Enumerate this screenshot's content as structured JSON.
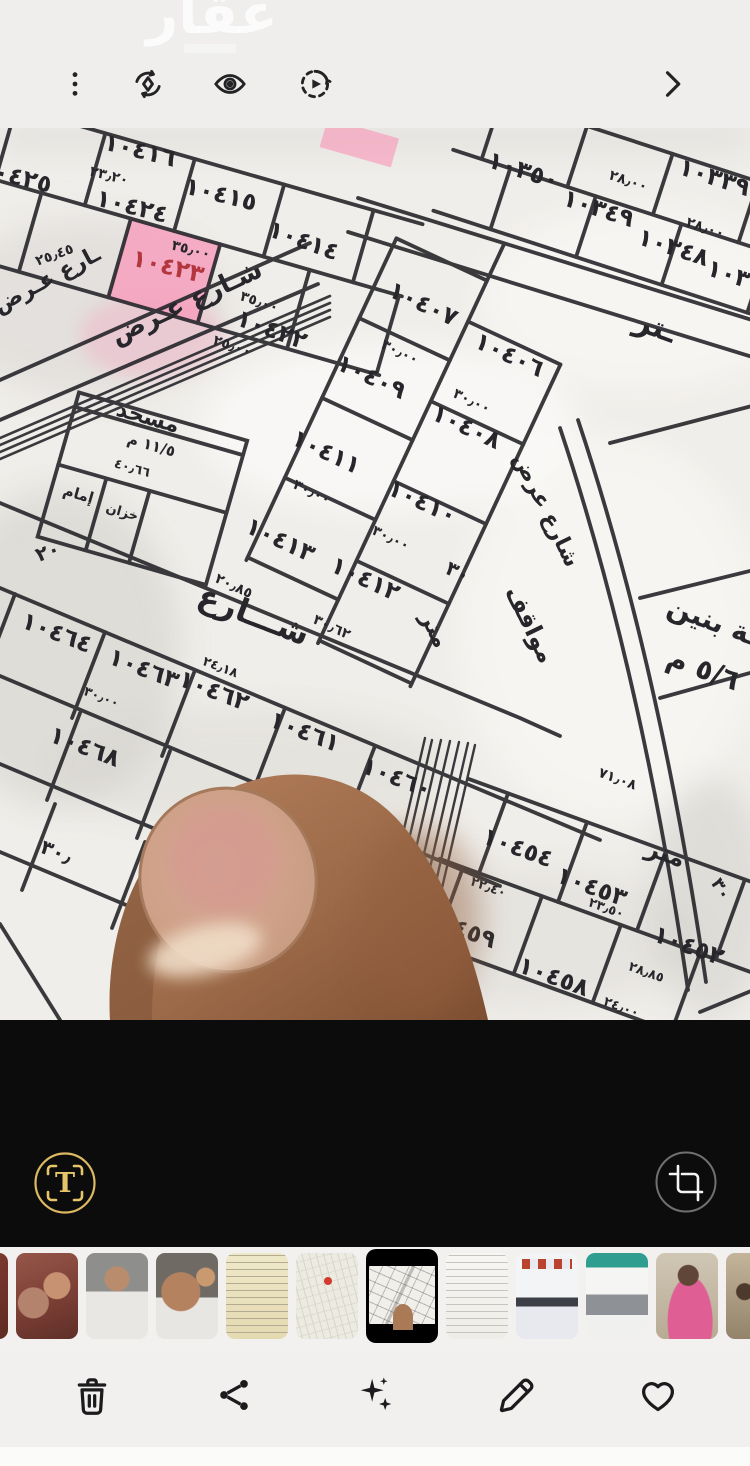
{
  "watermark": {
    "text": "عقار"
  },
  "top_bar": {
    "icons": [
      {
        "name": "more-options-icon"
      },
      {
        "name": "remaster-icon"
      },
      {
        "name": "show-details-eye-icon"
      },
      {
        "name": "motion-photo-icon"
      },
      {
        "name": "next-chevron-icon"
      }
    ]
  },
  "viewer_panel": {
    "buttons": [
      {
        "name": "extract-text"
      },
      {
        "name": "crop-rotate"
      }
    ],
    "accent_gold": "#e6c468"
  },
  "bottom_toolbar": {
    "buttons": [
      {
        "name": "delete"
      },
      {
        "name": "share"
      },
      {
        "name": "enhance"
      },
      {
        "name": "edit"
      },
      {
        "name": "favorite"
      }
    ]
  },
  "map": {
    "ink": "#26262b",
    "paper": "#f0eeea",
    "highlight_color": "#f6a0bd",
    "highlighted_parcel": "١٠٤٢٣",
    "labels": [
      {
        "t": "١٠٤١٦",
        "x": 138,
        "y": 30,
        "r": 14
      },
      {
        "t": "٢٣٫٢٠",
        "x": 108,
        "y": 52,
        "r": 14,
        "s": 14
      },
      {
        "t": "١٠٤٢٥",
        "x": 14,
        "y": 56,
        "r": 14
      },
      {
        "t": "١٠٤٢٤",
        "x": 130,
        "y": 86,
        "r": 14
      },
      {
        "t": "١٠٤١٥",
        "x": 219,
        "y": 74,
        "r": 14
      },
      {
        "t": "١٠٤١٤",
        "x": 301,
        "y": 120,
        "r": 20
      },
      {
        "t": "٣٥٫٠٠",
        "x": 190,
        "y": 126,
        "r": 14,
        "s": 14
      },
      {
        "t": "١٠٤٢٣",
        "x": 166,
        "y": 146,
        "r": 14,
        "c": "#b4373f"
      },
      {
        "t": "٣٥٫٠٠",
        "x": 258,
        "y": 178,
        "r": 18,
        "s": 14
      },
      {
        "t": "١٠٤٢٢",
        "x": 269,
        "y": 209,
        "r": 20
      },
      {
        "t": "٢٥٫٠٠",
        "x": 231,
        "y": 222,
        "r": 18,
        "s": 14
      },
      {
        "t": "٢٥٫٤٥",
        "x": 56,
        "y": 131,
        "r": -20,
        "s": 14
      },
      {
        "t": "١٠٣٥٠",
        "x": 521,
        "y": 50,
        "r": 18
      },
      {
        "t": "٢٨٫٠٠",
        "x": 627,
        "y": 57,
        "r": 18,
        "s": 14
      },
      {
        "t": "١٠٣٣٩",
        "x": 712,
        "y": 57,
        "r": 18
      },
      {
        "t": "١٠٣٤٩",
        "x": 596,
        "y": 88,
        "r": 18
      },
      {
        "t": "٢٨٫٠٠",
        "x": 704,
        "y": 104,
        "r": 18,
        "s": 14
      },
      {
        "t": "١٠٣٤٨",
        "x": 671,
        "y": 127,
        "r": 18
      },
      {
        "t": "١٠٣٣٨",
        "x": 740,
        "y": 158,
        "r": 18
      },
      {
        "t": "ـتر",
        "x": 652,
        "y": 208,
        "r": 20,
        "s": 30
      },
      {
        "t": "١٠٤٠٧",
        "x": 420,
        "y": 183,
        "r": 25
      },
      {
        "t": "٣٠٫٠٠",
        "x": 398,
        "y": 228,
        "r": 25,
        "s": 14
      },
      {
        "t": "١٠٤٠٦",
        "x": 506,
        "y": 234,
        "r": 25
      },
      {
        "t": "١٠٤٠٩",
        "x": 368,
        "y": 256,
        "r": 25
      },
      {
        "t": "٣٠٫٠٠",
        "x": 470,
        "y": 277,
        "r": 25,
        "s": 14
      },
      {
        "t": "١٠٤٠٨",
        "x": 463,
        "y": 306,
        "r": 25
      },
      {
        "t": "١٠٤١١",
        "x": 323,
        "y": 331,
        "r": 25
      },
      {
        "t": "٣٠٫٠٠",
        "x": 310,
        "y": 368,
        "r": 25,
        "s": 14
      },
      {
        "t": "١٠٤١٠",
        "x": 419,
        "y": 381,
        "r": 25
      },
      {
        "t": "٣٠٫٠٠",
        "x": 389,
        "y": 414,
        "r": 25,
        "s": 14
      },
      {
        "t": "١٠٤١٣",
        "x": 277,
        "y": 419,
        "r": 25
      },
      {
        "t": "١٠٤١٢",
        "x": 362,
        "y": 458,
        "r": 25
      },
      {
        "t": "٢٠٫٨٥",
        "x": 232,
        "y": 462,
        "r": 25,
        "s": 14
      },
      {
        "t": "٣٠٫٦٢",
        "x": 330,
        "y": 503,
        "r": 25,
        "s": 14
      },
      {
        "t": "مسجد",
        "x": 146,
        "y": 296,
        "r": 16,
        "s": 22
      },
      {
        "t": "١١/٥ م",
        "x": 150,
        "y": 322,
        "r": 16,
        "s": 15
      },
      {
        "t": "٤٠٫٦٦",
        "x": 131,
        "y": 344,
        "r": 16,
        "s": 13
      },
      {
        "t": "إمام",
        "x": 77,
        "y": 371,
        "r": 16,
        "s": 15
      },
      {
        "t": "خزان",
        "x": 121,
        "y": 388,
        "r": 16,
        "s": 13
      },
      {
        "t": "٢٠",
        "x": 50,
        "y": 430,
        "r": -20,
        "s": 20
      },
      {
        "t": "شـارع عـرض",
        "x": 190,
        "y": 182,
        "r": -25,
        "s": 26
      },
      {
        "t": "ـارع عـرض",
        "x": 50,
        "y": 158,
        "r": -28,
        "s": 22
      },
      {
        "t": "شارع عرض",
        "x": 540,
        "y": 385,
        "r": 64,
        "s": 22
      },
      {
        "t": "مواقف",
        "x": 523,
        "y": 500,
        "r": 64,
        "s": 24
      },
      {
        "t": "متر",
        "x": 428,
        "y": 505,
        "r": 64,
        "s": 22
      },
      {
        "t": "٣٠",
        "x": 455,
        "y": 450,
        "r": 25,
        "s": 20
      },
      {
        "t": "شـــارع",
        "x": 250,
        "y": 497,
        "r": 21,
        "s": 32
      },
      {
        "t": "ـة بنين",
        "x": 710,
        "y": 502,
        "r": 20,
        "s": 28
      },
      {
        "t": "٥/٦ م",
        "x": 700,
        "y": 550,
        "r": 20,
        "s": 28
      },
      {
        "t": "١٠٤٦٤",
        "x": 54,
        "y": 512,
        "r": 21
      },
      {
        "t": "١٠٤٦٣",
        "x": 141,
        "y": 548,
        "r": 21
      },
      {
        "t": "٢٤٫١٨",
        "x": 219,
        "y": 543,
        "r": 21,
        "s": 13
      },
      {
        "t": "١٠٤٦٢",
        "x": 211,
        "y": 570,
        "r": 21
      },
      {
        "t": "٣٠٫٠٠",
        "x": 100,
        "y": 573,
        "r": 21,
        "s": 13
      },
      {
        "t": "١٠٤٦١",
        "x": 302,
        "y": 611,
        "r": 21
      },
      {
        "t": "١٠٤٦٨",
        "x": 82,
        "y": 626,
        "r": 21
      },
      {
        "t": "١٠٤٦٠",
        "x": 394,
        "y": 657,
        "r": 21
      },
      {
        "t": "٧١٫٠٨",
        "x": 616,
        "y": 655,
        "r": 20,
        "s": 14
      },
      {
        "t": "٣٠٫",
        "x": 54,
        "y": 730,
        "r": 21,
        "s": 20
      },
      {
        "t": "٢٢٫٣٥",
        "x": 378,
        "y": 704,
        "r": 21,
        "s": 14
      },
      {
        "t": "١٠٤٦٥",
        "x": 348,
        "y": 754,
        "r": 21
      },
      {
        "t": "٢٢٫٣٠",
        "x": 333,
        "y": 790,
        "r": 21,
        "s": 14
      },
      {
        "t": "متر",
        "x": 663,
        "y": 733,
        "r": 20,
        "s": 24
      },
      {
        "t": "١٠٤٥٤",
        "x": 515,
        "y": 727,
        "r": 20
      },
      {
        "t": "٢٢٫٤٠",
        "x": 487,
        "y": 763,
        "r": 20,
        "s": 13
      },
      {
        "t": "١٠٤٥٣",
        "x": 589,
        "y": 766,
        "r": 20
      },
      {
        "t": "٢٣٫٥٠",
        "x": 605,
        "y": 784,
        "r": 20,
        "s": 13
      },
      {
        "t": "١٠٤٥٩",
        "x": 458,
        "y": 808,
        "r": 20
      },
      {
        "t": "١٠٤٥٢",
        "x": 686,
        "y": 825,
        "r": 20
      },
      {
        "t": "٢٨٫٨٥",
        "x": 645,
        "y": 848,
        "r": 20,
        "s": 13
      },
      {
        "t": "١٠٤٥٨",
        "x": 551,
        "y": 856,
        "r": 20
      },
      {
        "t": "٢٤٫٠٠",
        "x": 620,
        "y": 883,
        "r": 20,
        "s": 13
      },
      {
        "t": "٣٠",
        "x": 716,
        "y": 764,
        "r": 60,
        "s": 18
      }
    ]
  },
  "thumbnails": [
    {
      "kind": "photo-partial-red"
    },
    {
      "kind": "selfie-red"
    },
    {
      "kind": "selfie-elevator"
    },
    {
      "kind": "selfie-closeup"
    },
    {
      "kind": "document-yellow"
    },
    {
      "kind": "map-screenshot"
    },
    {
      "kind": "map-photo-current",
      "selected": true
    },
    {
      "kind": "document-table"
    },
    {
      "kind": "document-bill"
    },
    {
      "kind": "app-screenshot-teal"
    },
    {
      "kind": "photo-girl-pink"
    },
    {
      "kind": "photo-family"
    },
    {
      "kind": "photo-partial-beige"
    }
  ]
}
